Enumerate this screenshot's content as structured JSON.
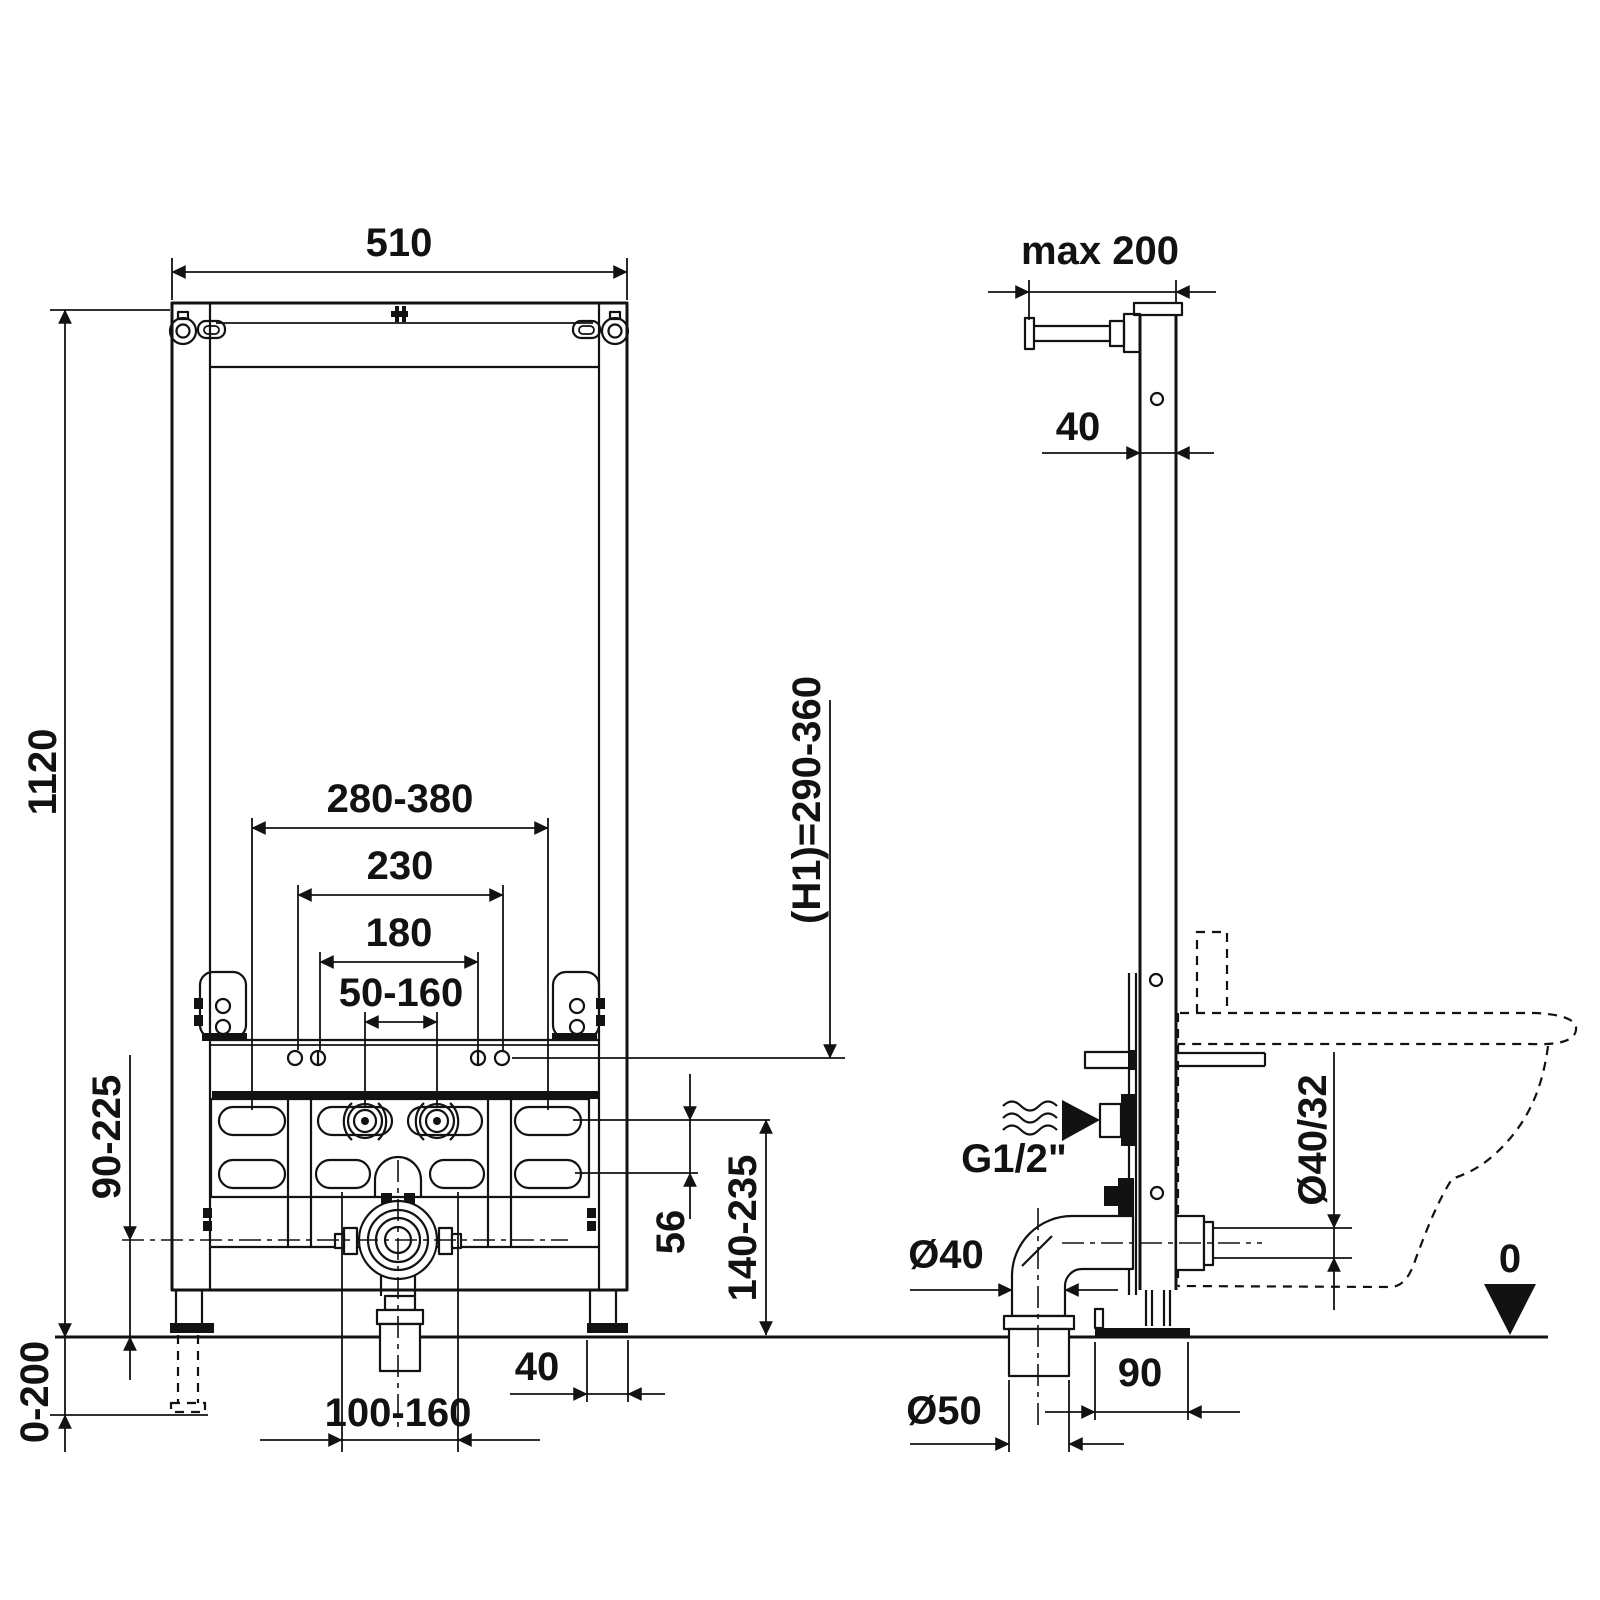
{
  "page": {
    "type": "installation-drawing",
    "background_color": "#ffffff",
    "line_color": "#121212"
  },
  "front_view": {
    "name": "bidet-frame-front-view",
    "dimensions": {
      "frame_width": "510",
      "frame_height": "1120",
      "mount_bolt_spacing": "280-380",
      "hole_spacing_outer": "230",
      "hole_spacing_inner": "180",
      "supply_spacing": "50-160",
      "drain_center_height": "90-225",
      "leg_extension": "0-200",
      "drain_offset_range": "100-160",
      "foot_plate_width": "40",
      "slot_row_gap": "56",
      "plate_height_range": "140-235",
      "h1_height": "(H1)=290-360"
    }
  },
  "side_view": {
    "name": "bidet-frame-side-view",
    "dimensions": {
      "wall_distance": "max 200",
      "profile_depth": "40",
      "water_supply_thread": "G1/2\"",
      "outlet_diameter": "Ø40/32",
      "elbow_diameter": "Ø40",
      "drain_pipe_diameter": "Ø50",
      "drain_wall_offset": "90",
      "floor_datum": "0"
    }
  }
}
